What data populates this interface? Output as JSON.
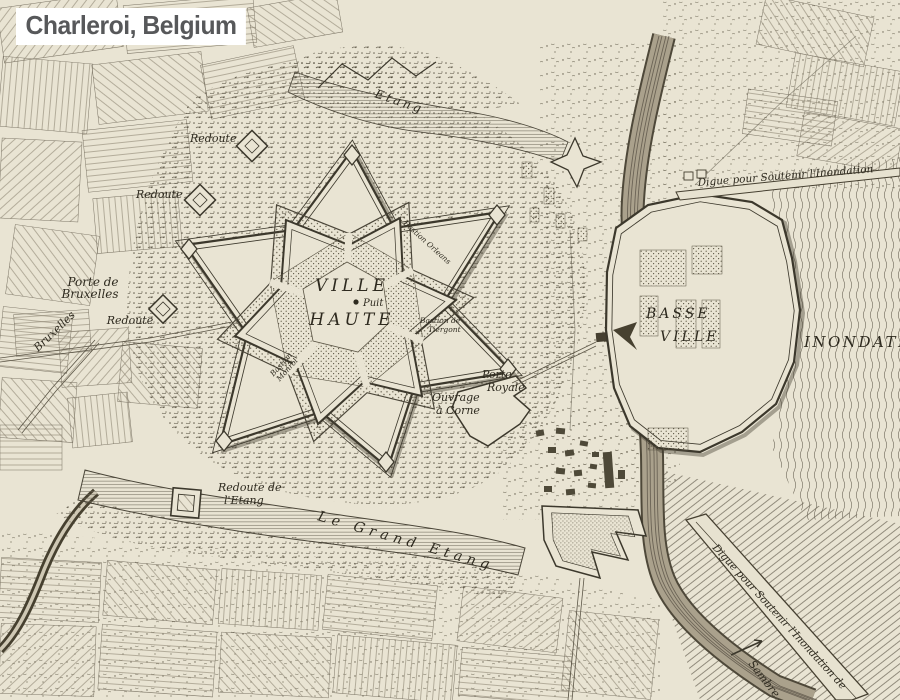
{
  "title": "Charleroi, Belgium",
  "colors": {
    "paper": "#e9e4d3",
    "ink": "#3c382c",
    "water_line": "#6d6758",
    "scrub": "#4a4434",
    "shadow": "#55503f",
    "title_text": "#57585a",
    "title_bg": "#ffffff"
  },
  "labels": {
    "etang": "Etang",
    "redoute_a": "Redoute",
    "redoute_b": "Redoute",
    "redoute_c": "Redoute",
    "porte_bruxelles_1": "Porte de",
    "porte_bruxelles_2": "Bruxelles",
    "bruxelles_road": "Bruxelles",
    "ville": "VILLE",
    "haute": "HAUTE",
    "puit": "Puit",
    "bastion_tiergont_1": "Bastion de",
    "bastion_tiergont_2": "Tiergont",
    "bastion_monroi_1": "Bastion",
    "bastion_monroi_2": "Monroi",
    "bastion_orleans": "Bastion Orleans",
    "porte_royale_1": "Porte",
    "porte_royale_2": "Royale",
    "ouvrage_corne_1": "Ouvrage",
    "ouvrage_corne_2": "à Corne",
    "basse": "BASSE",
    "basse_ville": "VILLE",
    "inondation": "INONDATION",
    "digue_nord": "Digue pour Soutenir l'Inondation",
    "digue_sud": "Digue pour Soutenir l'Inondation de",
    "redoute_etang_1": "Redoute de",
    "redoute_etang_2": "l'Etang",
    "grand_etang": "Le Grand Etang",
    "sambre": "Sambre"
  }
}
